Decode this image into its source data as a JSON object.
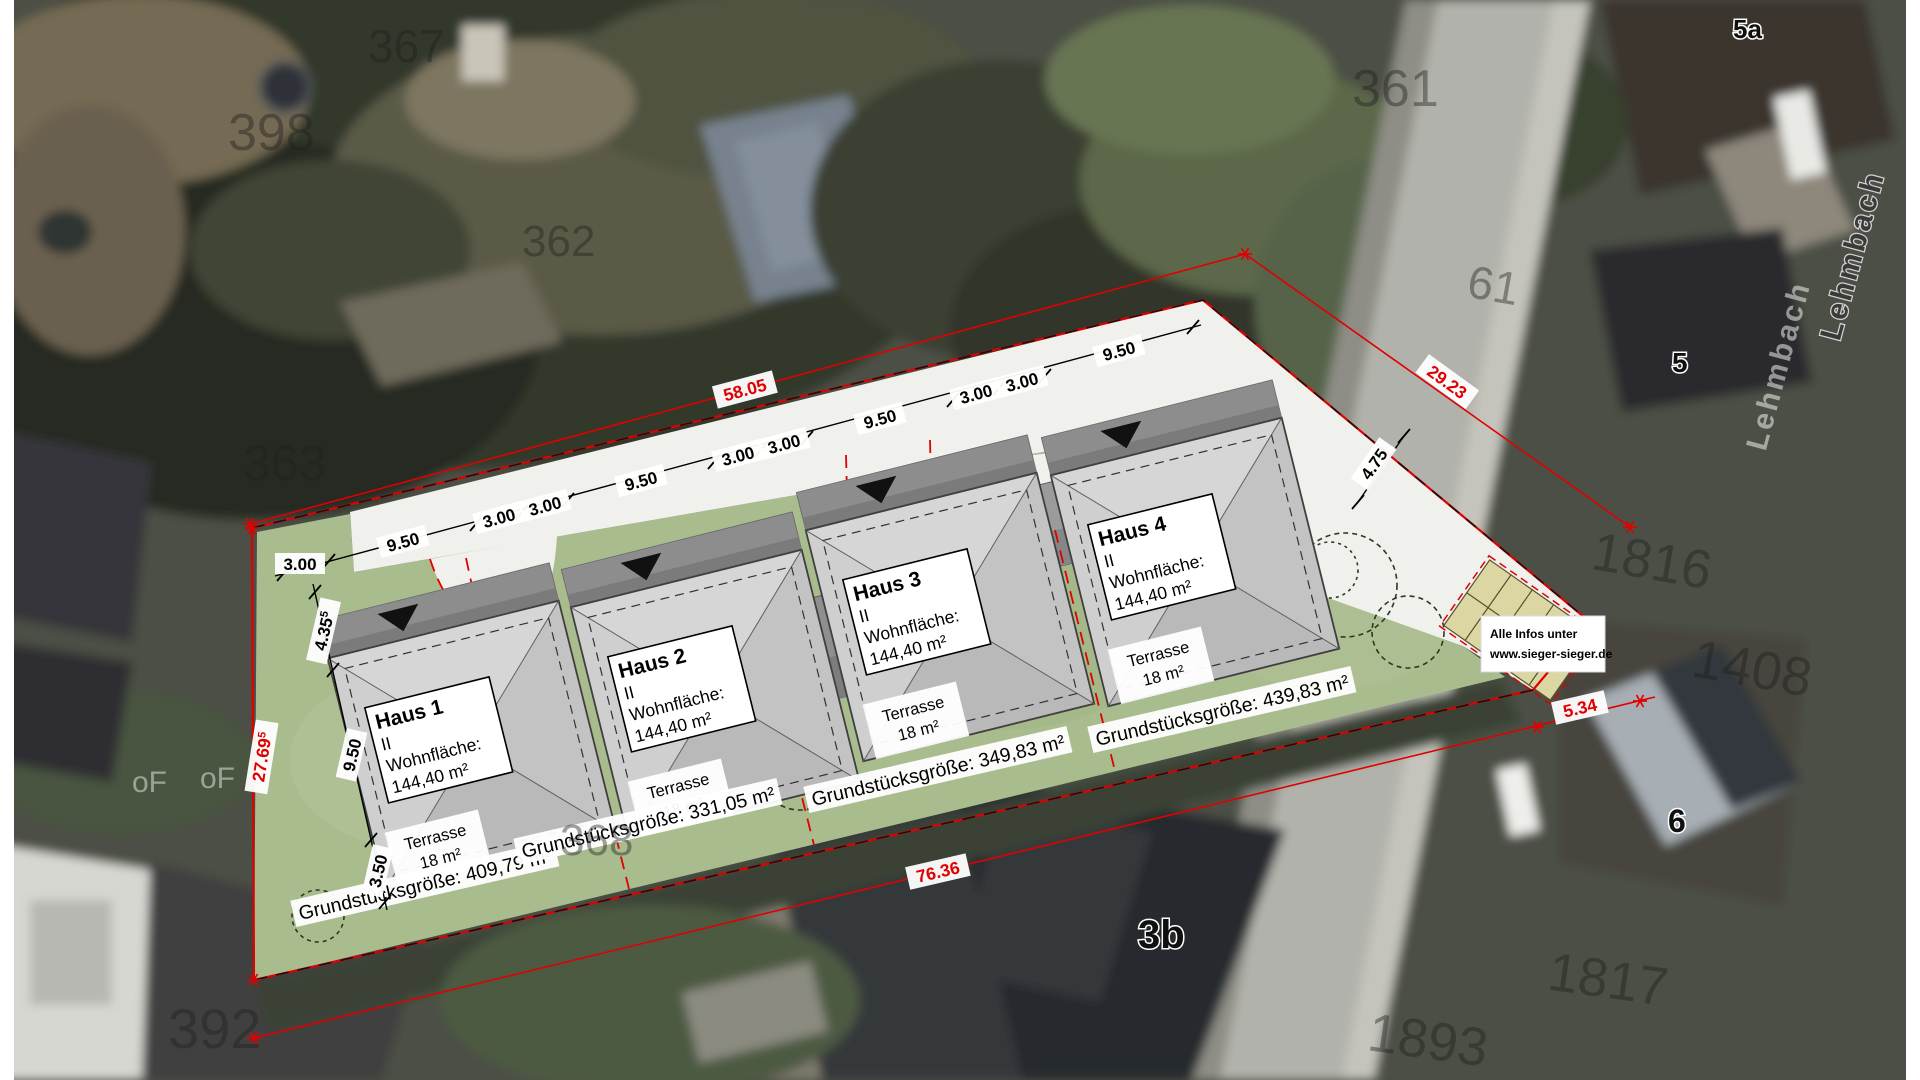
{
  "plan": {
    "houses": [
      {
        "name": "Haus 1",
        "storeys": "II",
        "area_label": "Wohnfläche:",
        "area_value": "144,40 m²",
        "terrace_label": "Terrasse",
        "terrace_area": "18 m²",
        "plot_label": "Grundstücksgröße: 409,79 m²"
      },
      {
        "name": "Haus 2",
        "storeys": "II",
        "area_label": "Wohnfläche:",
        "area_value": "144,40 m²",
        "terrace_label": "Terrasse",
        "terrace_area": "18 m²",
        "plot_label": "Grundstücksgröße: 331,05 m²"
      },
      {
        "name": "Haus 3",
        "storeys": "II",
        "area_label": "Wohnfläche:",
        "area_value": "144,40 m²",
        "terrace_label": "Terrasse",
        "terrace_area": "18 m²",
        "plot_label": "Grundstücksgröße: 349,83 m²"
      },
      {
        "name": "Haus 4",
        "storeys": "II",
        "area_label": "Wohnfläche:",
        "area_value": "144,40 m²",
        "terrace_label": "Terrasse",
        "terrace_area": "18 m²",
        "plot_label": "Grundstücksgröße: 439,83 m²"
      }
    ],
    "dimensions": {
      "top_chain": [
        "3.00",
        "9.50",
        "3.00",
        "3.00",
        "9.50",
        "3.00",
        "3.00",
        "9.50",
        "3.00",
        "3.00",
        "9.50"
      ],
      "left_chain": [
        {
          "value": "4.35",
          "sup": "5"
        },
        {
          "value": "9.50",
          "sup": ""
        },
        {
          "value": "3.50",
          "sup": ""
        }
      ],
      "right_width": "4.75",
      "red": {
        "top": "58.05",
        "right": "29.23",
        "left": {
          "value": "27.69",
          "sup": "5"
        },
        "bottom": "76.36",
        "street": "5.34"
      }
    },
    "info_box": {
      "line1": "Alle Infos unter",
      "line2": "www.sieger-sieger.de"
    }
  },
  "map": {
    "street_name": "Lehmbach",
    "parcels": [
      "398",
      "367",
      "361",
      "362",
      "363",
      "392",
      "368",
      "61",
      "1816",
      "1408",
      "1817",
      "1893"
    ],
    "house_numbers": [
      "5a",
      "5",
      "3b",
      "6"
    ],
    "ghosts": [
      "oF",
      "oF"
    ]
  }
}
